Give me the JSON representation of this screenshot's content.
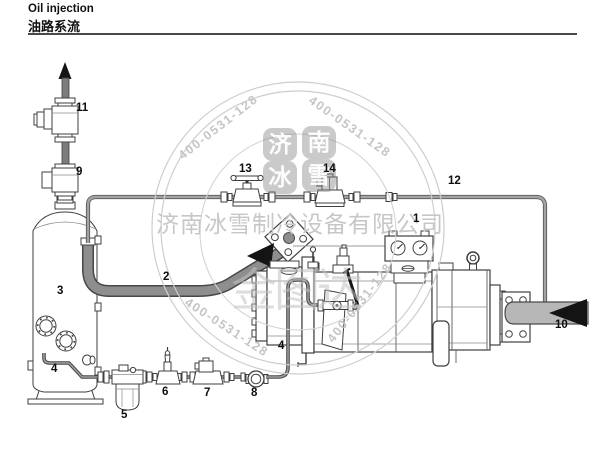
{
  "header": {
    "title_en": "Oil injection",
    "title_zh": "油路系流"
  },
  "watermark": {
    "phone": "400-0531-128",
    "company": "济南冰雪制冷设备有限公司",
    "brand": "金图达",
    "seal": {
      "c1": "济",
      "c2": "南",
      "c3": "冰",
      "c4": "雪"
    }
  },
  "parts": [
    "1",
    "2",
    "3",
    "4",
    "4",
    "5",
    "6",
    "7",
    "8",
    "9",
    "10",
    "11",
    "12",
    "13",
    "14"
  ]
}
